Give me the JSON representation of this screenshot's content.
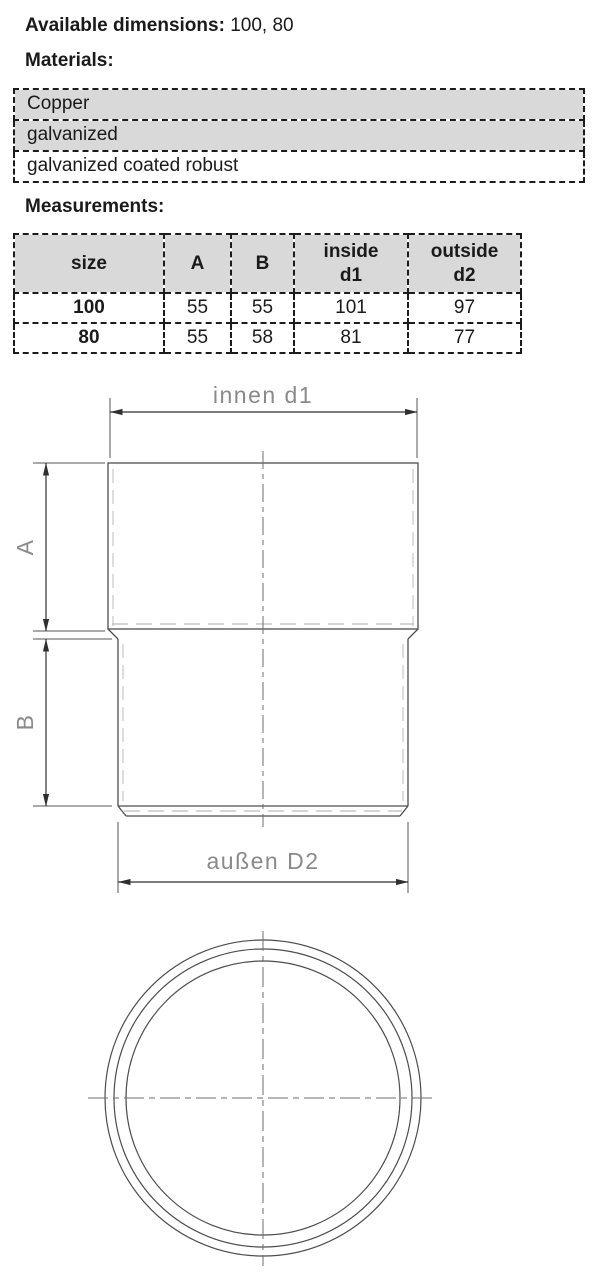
{
  "header": {
    "available_dimensions_label": "Available dimensions:",
    "available_dimensions_value": "100, 80",
    "materials_label": "Materials:",
    "measurements_label": "Measurements:"
  },
  "materials": {
    "rows": [
      "Copper",
      "galvanized",
      "galvanized coated robust"
    ]
  },
  "measurements": {
    "columns": {
      "size": "size",
      "a": "A",
      "b": "B",
      "d1_line1": "inside",
      "d1_line2": "d1",
      "d2_line1": "outside",
      "d2_line2": "d2"
    },
    "rows": [
      {
        "size": "100",
        "a": "55",
        "b": "55",
        "d1": "101",
        "d2": "97"
      },
      {
        "size": "80",
        "a": "55",
        "b": "58",
        "d1": "81",
        "d2": "77"
      }
    ]
  },
  "diagram": {
    "labels": {
      "top_dimension": "innen d1",
      "upper_height_dimension": "A",
      "lower_height_dimension": "B",
      "bottom_dimension": "außen D2"
    }
  },
  "colors": {
    "table_header_bg": "#d9d9d9",
    "outline": "#4d4d4d",
    "hidden_line": "#bcbcbc",
    "centerline": "#6e6e6e",
    "dimension_line": "#2f2f2f",
    "dimension_text": "#8a8a8a"
  }
}
